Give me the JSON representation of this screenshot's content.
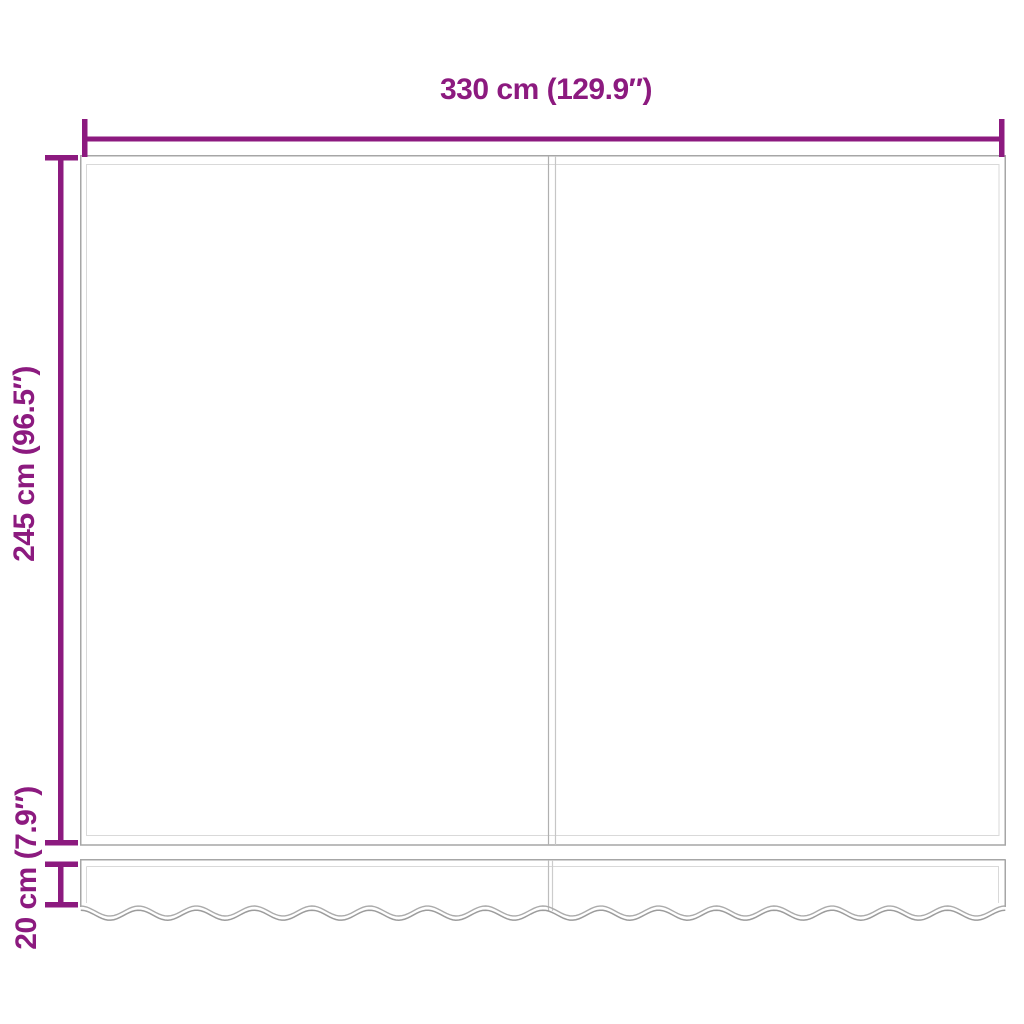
{
  "diagram": {
    "title": "awning-fabric-dimension-diagram",
    "width_dimension": {
      "label": "330 cm (129.9″)"
    },
    "height_dimension": {
      "label": "245 cm (96.5″)"
    },
    "valance_dimension": {
      "label": "20 cm (7.9″)"
    },
    "colors": {
      "dimension_accent": "#8C1A7F",
      "outline_gray": "#A6A6A6",
      "outline_light_gray": "#D9D9D9",
      "background": "#FFFFFF"
    }
  }
}
